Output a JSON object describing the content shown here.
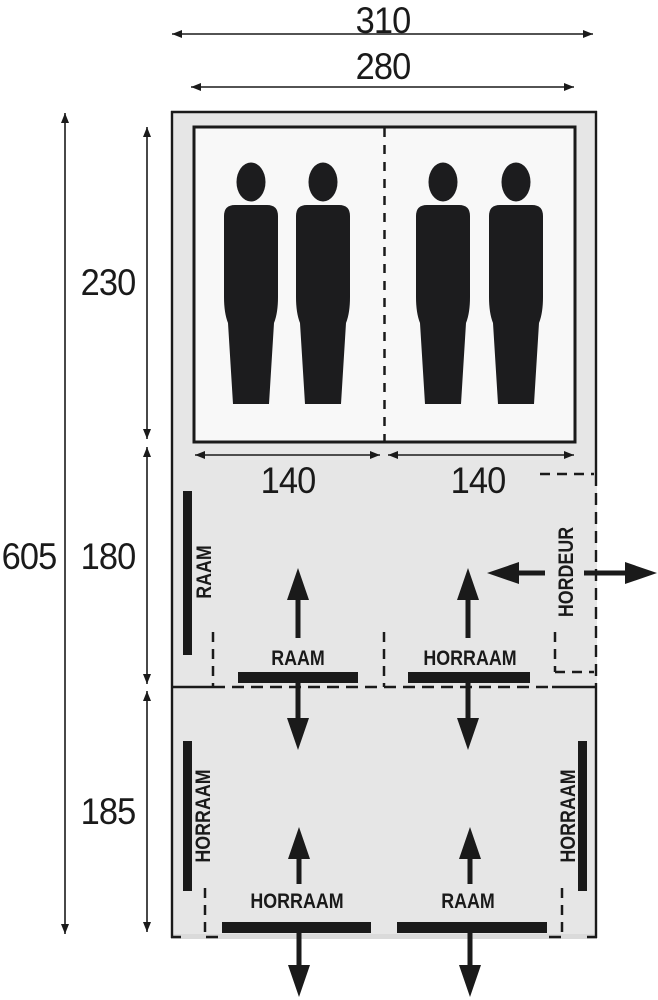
{
  "figure": {
    "type": "tent-floorplan",
    "dimensions": {
      "outer_width": "310",
      "inner_width": "280",
      "total_depth": "605",
      "cabin_depth": "230",
      "living_depth": "180",
      "rear_depth": "185",
      "cabin_left_width": "140",
      "cabin_right_width": "140"
    },
    "features": {
      "living_left_wall_window": "RAAM",
      "living_window_left": "RAAM",
      "living_window_right": "HORRAAM",
      "side_door": "HORDEUR",
      "rear_left_wall_window": "HORRAAM",
      "rear_right_wall_window": "HORRAAM",
      "rear_window_left": "HORRAAM",
      "rear_window_right": "RAAM"
    },
    "occupants": 4,
    "colors": {
      "line": "#1a1a1a",
      "tent_fill": "#e6e6e6",
      "cabin_fill": "#f8f8f8",
      "silhouette": "#1c1c1e"
    },
    "icons": {
      "person": "person-silhouette",
      "airflow": "thick-black-arrow",
      "dimension": "double-headed-thin-arrow"
    }
  }
}
